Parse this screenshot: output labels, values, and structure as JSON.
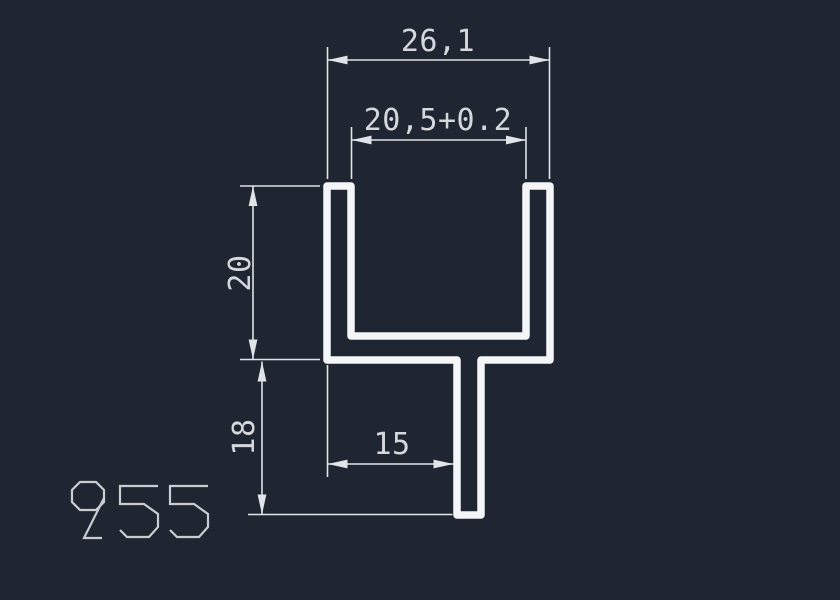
{
  "colors": {
    "background": "#202631",
    "profile_line": "#f3f5f7",
    "dimension_line": "#e0e3e7",
    "dimension_text": "#d4d7db",
    "part_label": "#c9cdd2"
  },
  "drawing": {
    "type": "cad-profile-cross-section",
    "dimensions": {
      "outer_width": {
        "label": "26,1",
        "orientation": "horizontal"
      },
      "inner_width": {
        "label": "20,5+0.2",
        "orientation": "horizontal"
      },
      "channel_height": {
        "label": "20",
        "orientation": "vertical"
      },
      "stem_height": {
        "label": "18",
        "orientation": "vertical"
      },
      "stem_offset": {
        "label": "15",
        "orientation": "horizontal"
      }
    },
    "part_number": {
      "text": "955"
    }
  }
}
